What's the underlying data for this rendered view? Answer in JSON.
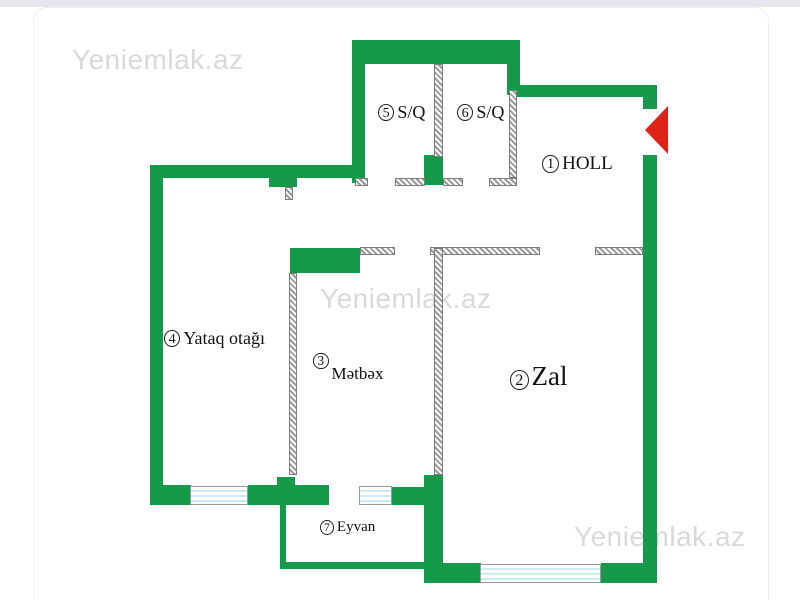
{
  "watermark": "Yeniemlak.az",
  "plan": {
    "rooms": [
      {
        "num": "1",
        "name": "HOLL"
      },
      {
        "num": "2",
        "name": "Zal"
      },
      {
        "num": "3",
        "name": "Mətbəx"
      },
      {
        "num": "4",
        "name": "Yataq otağı"
      },
      {
        "num": "5",
        "name": "S/Q"
      },
      {
        "num": "6",
        "name": "S/Q"
      },
      {
        "num": "7",
        "name": "Eyvan"
      }
    ]
  },
  "colors": {
    "wall_green": "#149a48",
    "entrance_red": "#de2318",
    "watermark_gray": "#d9d9d9",
    "window_blue": "#cdeaf2"
  }
}
